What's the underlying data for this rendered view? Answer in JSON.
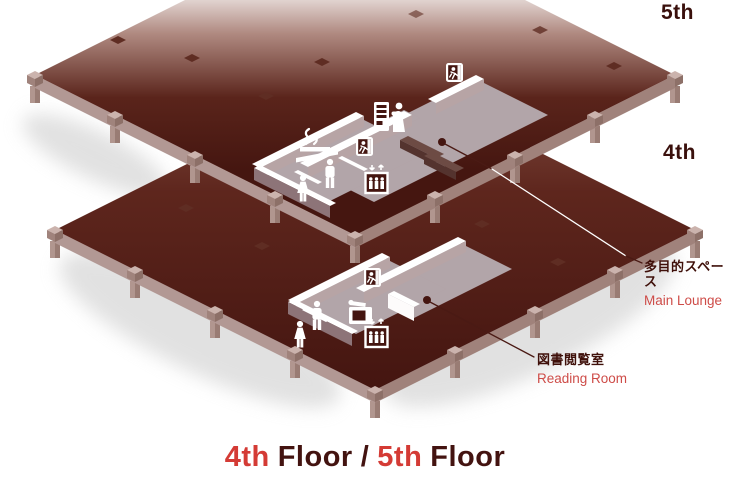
{
  "diagram": {
    "floors": [
      {
        "id": "5f",
        "tag": "5th",
        "room": {
          "name_jp": "多目的スペース",
          "name_en": "Main Lounge"
        },
        "facilities": [
          "emergency-exit",
          "vending-machine",
          "smoking-area",
          "mens-restroom",
          "womens-restroom",
          "elevator"
        ]
      },
      {
        "id": "4f",
        "tag": "4th",
        "room": {
          "name_jp": "図書閲覧室",
          "name_en": "Reading Room"
        },
        "facilities": [
          "emergency-exit",
          "mens-restroom",
          "womens-restroom",
          "copy-machine",
          "elevator"
        ]
      }
    ],
    "title": {
      "num4": "4th",
      "word4": "Floor",
      "separator": "/",
      "num5": "5th",
      "word5": "Floor"
    },
    "colors": {
      "slab_top": "#451610",
      "slab_side_light": "#b29894",
      "slab_side_dark": "#a0827b",
      "room_floor": "#b2a5a9",
      "wall_white": "#ffffff",
      "label_jp": "#3f100a",
      "label_en": "#ce4c48",
      "title_red": "#d43b35",
      "title_dark": "#431310",
      "leader_line": "#4a1a14"
    }
  }
}
